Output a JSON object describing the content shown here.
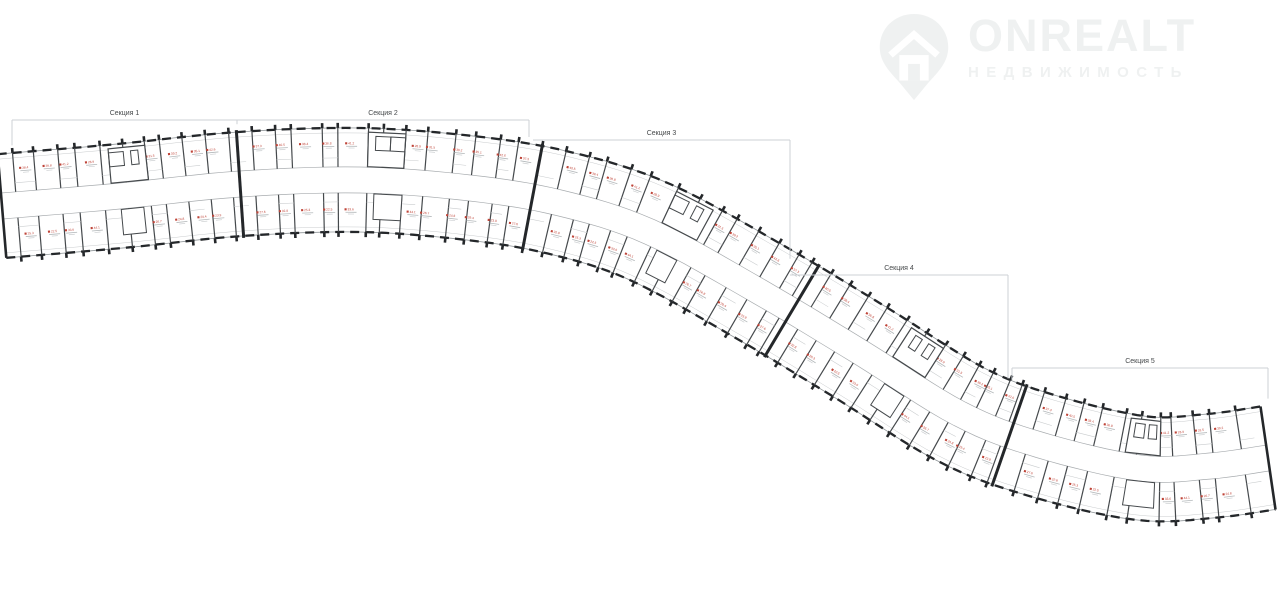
{
  "page": {
    "width": 1280,
    "height": 590,
    "background": "#ffffff"
  },
  "logo": {
    "brand": "ONREALT",
    "subtitle": "НЕДВИЖИМОСТЬ",
    "color": "#eff1f1",
    "icon": "house-pin-icon"
  },
  "plan": {
    "colors": {
      "wall_dark": "#24272a",
      "wall_medium": "#45494c",
      "line_light": "#8f9598",
      "line_faint": "#c9ccce",
      "corridor": "#a8acaf",
      "unit_red": "#bf4438",
      "bracket": "#cdd1d5",
      "bracket_text": "#46494b"
    },
    "half_width": 52,
    "corridor_half_width": 13,
    "divider_spacing": 21,
    "divider_jitter": [
      0,
      2,
      -3,
      4,
      -1,
      3,
      -4,
      1,
      -2,
      5
    ],
    "centerline": [
      [
        2,
        206
      ],
      [
        120,
        196
      ],
      [
        240,
        184
      ],
      [
        360,
        180
      ],
      [
        470,
        188
      ],
      [
        560,
        203
      ],
      [
        650,
        232
      ],
      [
        760,
        292
      ],
      [
        860,
        352
      ],
      [
        960,
        414
      ],
      [
        1040,
        445
      ],
      [
        1140,
        468
      ],
      [
        1210,
        466
      ],
      [
        1268,
        458
      ]
    ],
    "section_boundaries_x": [
      237,
      531,
      790,
      1010
    ],
    "sections": [
      {
        "label": "Секция 1",
        "x1": 12,
        "x2": 237,
        "bracket_y": 120
      },
      {
        "label": "Секция 2",
        "x1": 237,
        "x2": 529,
        "bracket_y": 120
      },
      {
        "label": "Секция 3",
        "x1": 533,
        "x2": 790,
        "bracket_y": 140
      },
      {
        "label": "Секция 4",
        "x1": 790,
        "x2": 1008,
        "bracket_y": 275
      },
      {
        "label": "Секция 5",
        "x1": 1012,
        "x2": 1268,
        "bracket_y": 368
      }
    ],
    "unit_area_values": [
      "38.4",
      "25.3",
      "36.8",
      "22.5",
      "41.2",
      "33.6",
      "28.9",
      "44.1",
      "31.5",
      "26.7",
      "39.2",
      "24.8",
      "35.1",
      "29.4",
      "42.6",
      "23.9",
      "37.3",
      "27.6",
      "40.5",
      "32.8"
    ]
  }
}
